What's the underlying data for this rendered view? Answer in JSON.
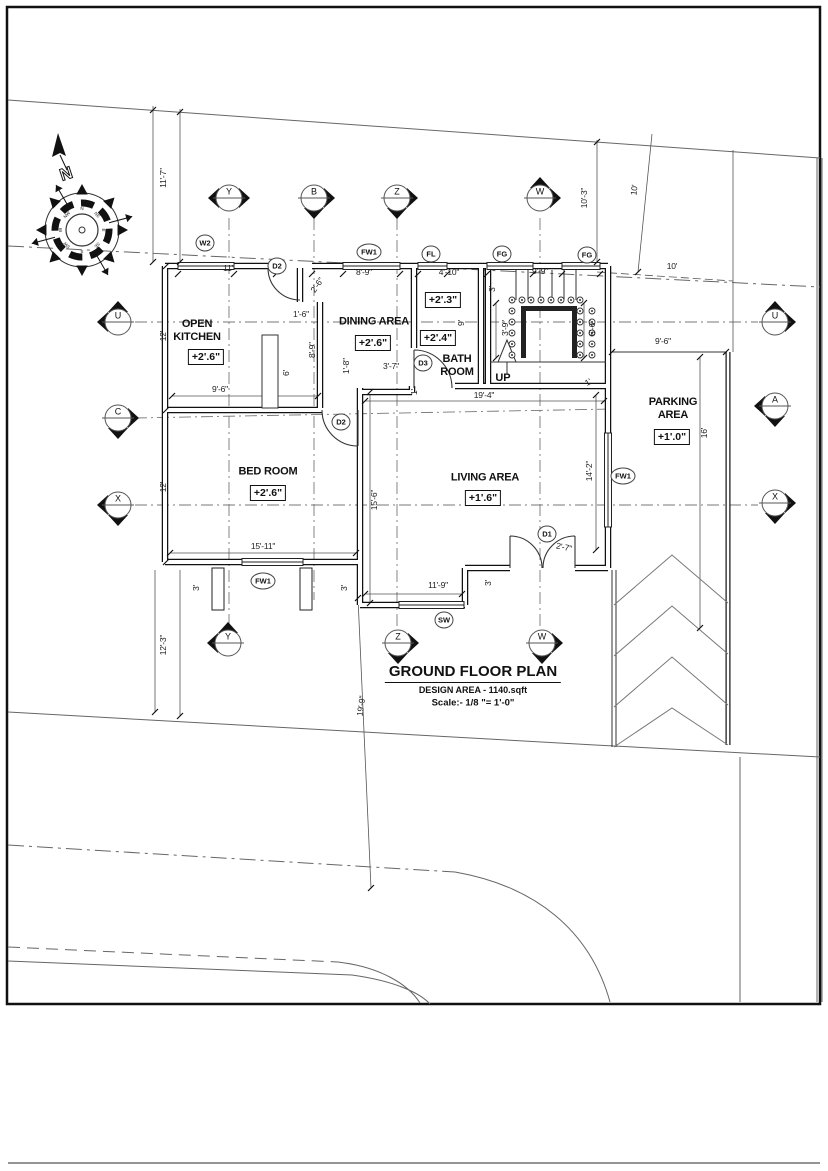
{
  "title_block": {
    "title": "GROUND FLOOR PLAN",
    "design_area": "DESIGN AREA - 1140.sqft",
    "scale": "Scale:- 1/8 \"= 1'-0\""
  },
  "compass": {
    "north_label": "N",
    "directions": [
      "N",
      "NE",
      "E",
      "SE",
      "S",
      "SW",
      "W",
      "NW"
    ]
  },
  "rooms": [
    {
      "id": "open-kitchen",
      "name": "OPEN KITCHEN",
      "level": "+2'.6\""
    },
    {
      "id": "dining-area",
      "name": "DINING AREA",
      "level": "+2'.6\""
    },
    {
      "id": "bath-room",
      "name": "BATH ROOM",
      "level_upper": "+2'.3\"",
      "level": "+2'.4\""
    },
    {
      "id": "bed-room",
      "name": "BED ROOM",
      "level": "+2'.6\""
    },
    {
      "id": "living-area",
      "name": "LIVING AREA",
      "level": "+1'.6\""
    },
    {
      "id": "parking-area",
      "name": "PARKING AREA",
      "level": "+1'.0\""
    }
  ],
  "stairs": {
    "direction_label": "UP"
  },
  "grid_markers": {
    "top": [
      "Y",
      "B",
      "Z",
      "W"
    ],
    "left": [
      "U",
      "C",
      "X"
    ],
    "right": [
      "U",
      "A",
      "X"
    ],
    "bottom": [
      "Y",
      "Z",
      "W"
    ]
  },
  "tags": [
    "W2",
    "FW1",
    "FL",
    "FG",
    "FG",
    "D2",
    "D3",
    "D2",
    "D1",
    "FW1",
    "SW",
    "FW1"
  ],
  "dimensions": [
    "11'-7\"",
    "10'-3\"",
    "10'",
    "10'",
    "11'",
    "8'-9\"",
    "4'-10\"",
    "9'-9\"",
    "2'-6\"",
    "1'-6\"",
    "12'",
    "8'-9\"",
    "6'",
    "9'-6\"",
    "1'-8\"",
    "3'-7\"",
    "3'",
    "9'",
    "3'-9\"",
    "6'-6\"",
    "1'",
    "19'-4\"",
    "1'",
    "12'",
    "15'-6\"",
    "14'-2\"",
    "15'-11\"",
    "3'",
    "3'",
    "11'-9\"",
    "3'",
    "2'-7\"",
    "16'",
    "9'-6\"",
    "12'-3\"",
    "19'-9\""
  ]
}
